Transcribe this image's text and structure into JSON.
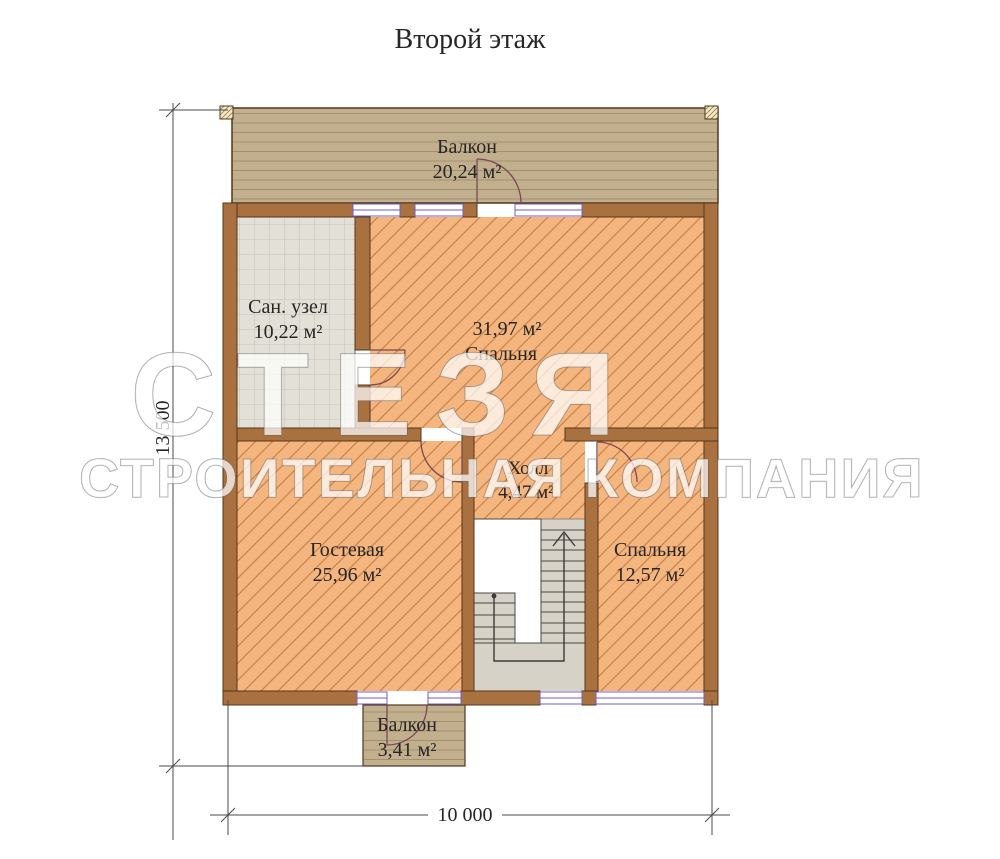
{
  "title": "Второй этаж",
  "watermark": {
    "line1": "СТЕЗЯ",
    "line2": "СТРОИТЕЛЬНАЯ КОМПАНИЯ"
  },
  "rooms": {
    "balcony_top": {
      "line1": "Балкон",
      "line2": "20,24 м²"
    },
    "san_uzel": {
      "line1": "Сан. узел",
      "line2": "10,22 м²"
    },
    "bedroom_main": {
      "line1": "31,97 м²",
      "line2": "Спальня"
    },
    "hall": {
      "line1": "Холл",
      "line2": "4,47 м²"
    },
    "guest": {
      "line1": "Гостевая",
      "line2": "25,96 м²"
    },
    "bedroom_small": {
      "line1": "Спальня",
      "line2": "12,57 м²"
    },
    "balcony_bottom": {
      "line1": "Балкон",
      "line2": "3,41 м²"
    }
  },
  "dimensions": {
    "height": "13 500",
    "width": "10 000"
  },
  "colors": {
    "floor_hatch_bg": "#f5b57f",
    "floor_hatch_line": "#c8834a",
    "wall_fill": "#aa7140",
    "wall_outline": "#53361e",
    "balcony_fill": "#c2af8d",
    "balcony_plank_line": "#a3906e",
    "tile_bg": "#e3e1d7",
    "tile_line": "#c6c4b8",
    "stair_fill": "#d6d2c7",
    "window_line": "#6f5ec4",
    "door_arc": "#7a4a52",
    "dimension_line": "#4a4a4a",
    "text": "#262626"
  }
}
